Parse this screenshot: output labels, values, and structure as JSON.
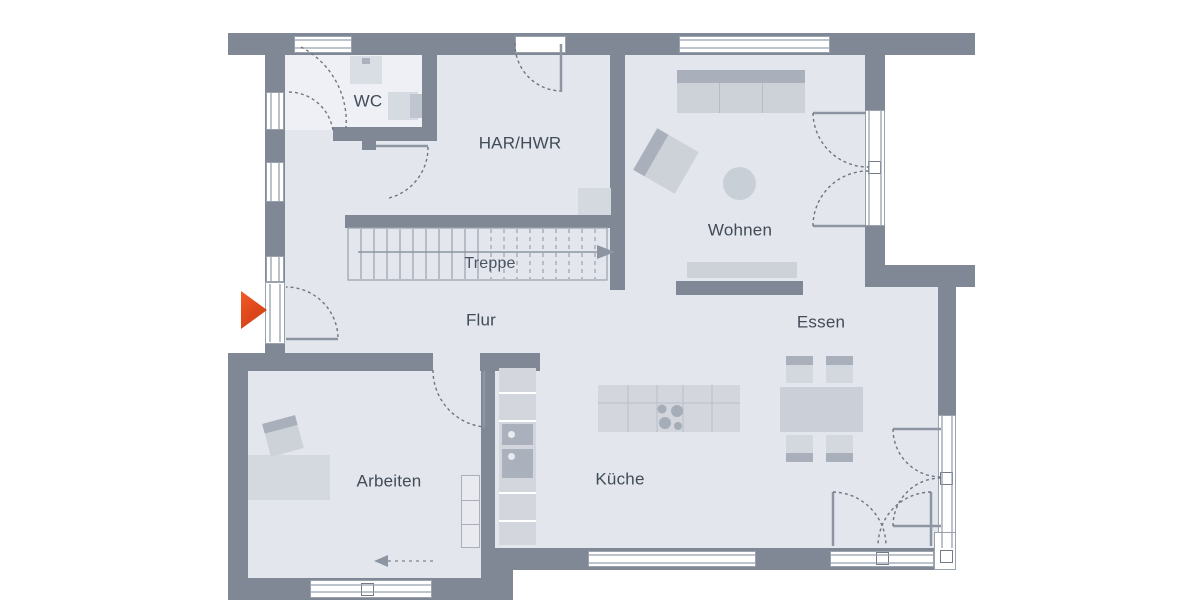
{
  "plan": {
    "kind": "floor-plan"
  },
  "rooms": [
    {
      "id": "wc",
      "label": "WC"
    },
    {
      "id": "har_hwr",
      "label": "HAR/HWR"
    },
    {
      "id": "treppe",
      "label": "Treppe"
    },
    {
      "id": "flur",
      "label": "Flur"
    },
    {
      "id": "wohnen",
      "label": "Wohnen"
    },
    {
      "id": "essen",
      "label": "Essen"
    },
    {
      "id": "arbeiten",
      "label": "Arbeiten"
    },
    {
      "id": "kueche",
      "label": "Küche"
    }
  ],
  "markers": {
    "entrance": {
      "name": "entrance-arrow",
      "color": "#e04a1c",
      "direction": "right"
    },
    "stairs": {
      "direction": "right"
    }
  },
  "colors": {
    "wall": "#7f8894",
    "floor": "#e3e6ec",
    "floor_wc": "#eef0f5",
    "furniture": "#cdd2d9",
    "furniture_dark": "#a9b0bb",
    "line": "#8d95a2",
    "label_text": "#414c58",
    "accent_arrow": "#e04a1c"
  }
}
